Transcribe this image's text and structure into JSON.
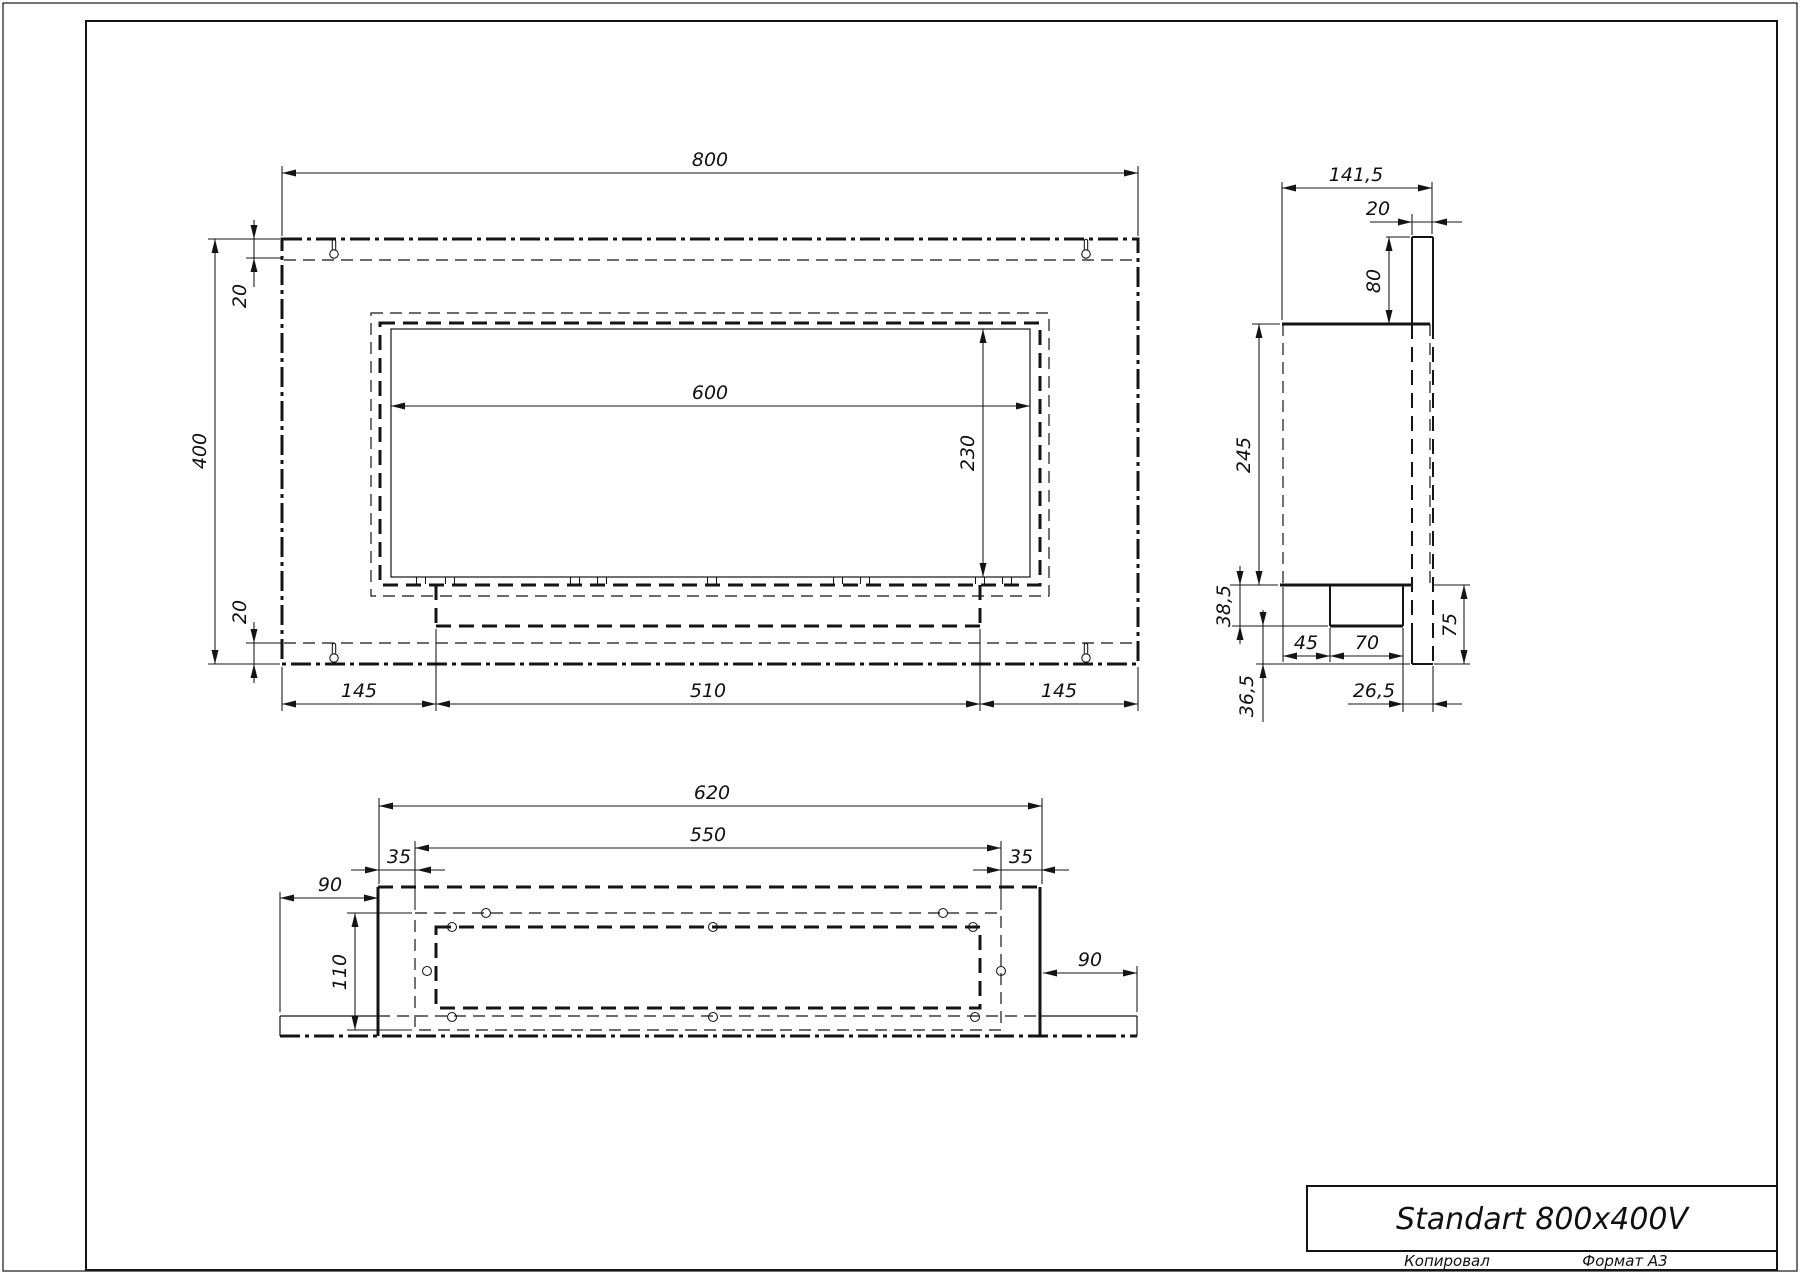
{
  "title_block": {
    "product_name": "Standart 800x400V",
    "footer_left": "Копировал",
    "footer_right": "Формат А3"
  },
  "front_view": {
    "width": "800",
    "height": "400",
    "inset_top": "20",
    "inset_bottom": "20",
    "opening_width": "600",
    "opening_height": "230",
    "tray_offset_left": "145",
    "tray_width": "510",
    "tray_offset_right": "145"
  },
  "side_view": {
    "depth": "141,5",
    "panel_thickness": "20",
    "top_offset": "80",
    "body_height": "245",
    "tray_drop": "38,5",
    "bottom_offset": "36,5",
    "tray_front_offset": "45",
    "tray_depth": "70",
    "panel_extension": "75",
    "tray_back_offset": "26,5"
  },
  "bottom_view": {
    "body_width": "620",
    "glass_width": "550",
    "inset_left": "35",
    "inset_right": "35",
    "wing_left": "90",
    "wing_right": "90",
    "glass_depth": "110"
  },
  "colors": {
    "ink": "#141414",
    "paper": "#ffffff"
  }
}
